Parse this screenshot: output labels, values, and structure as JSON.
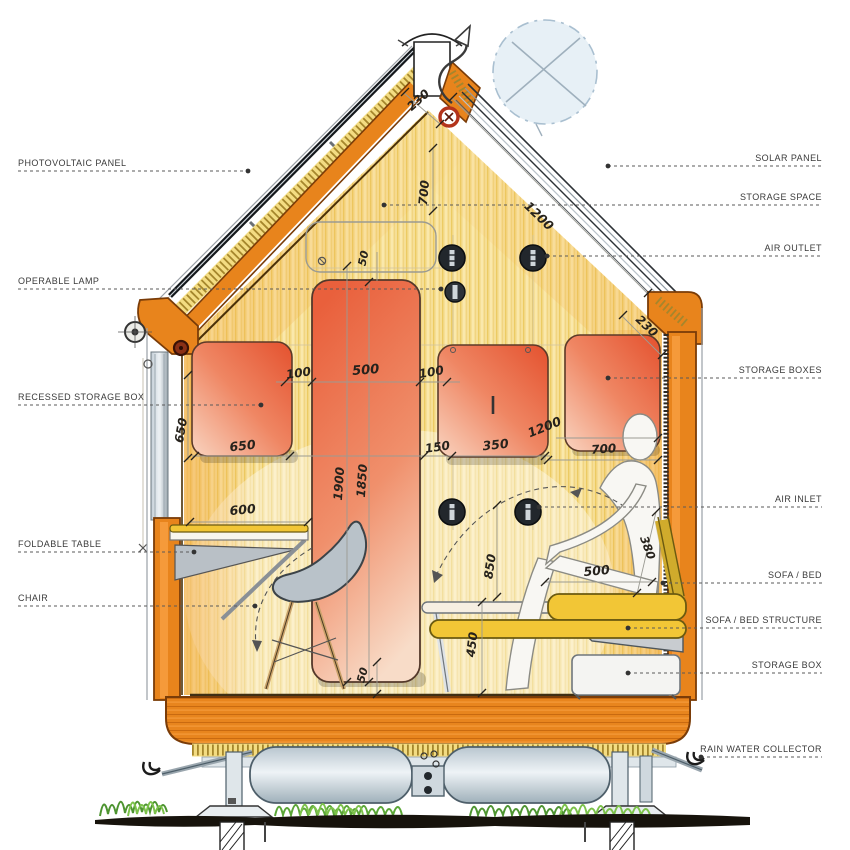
{
  "diagram": {
    "type": "architectural-section",
    "subject": "micro cabin / tiny house cross-section with callouts and millimetre dimensions"
  },
  "callouts": {
    "left": [
      {
        "label": "PHOTOVOLTAIC PANEL"
      },
      {
        "label": "OPERABLE LAMP"
      },
      {
        "label": "RECESSED STORAGE BOX"
      },
      {
        "label": "FOLDABLE TABLE"
      },
      {
        "label": "CHAIR"
      }
    ],
    "right": [
      {
        "label": "SOLAR PANEL"
      },
      {
        "label": "STORAGE SPACE"
      },
      {
        "label": "AIR OUTLET"
      },
      {
        "label": "STORAGE BOXES"
      },
      {
        "label": "AIR INLET"
      },
      {
        "label": "SOFA / BED"
      },
      {
        "label": "SOFA / BED STRUCTURE"
      },
      {
        "label": "STORAGE BOX"
      },
      {
        "label": "RAIN WATER COLLECTOR"
      }
    ]
  },
  "dimensions": [
    {
      "v": "230"
    },
    {
      "v": "50"
    },
    {
      "v": "700"
    },
    {
      "v": "1200"
    },
    {
      "v": "230"
    },
    {
      "v": "100"
    },
    {
      "v": "500"
    },
    {
      "v": "100"
    },
    {
      "v": "650"
    },
    {
      "v": "650"
    },
    {
      "v": "1900"
    },
    {
      "v": "1850"
    },
    {
      "v": "150"
    },
    {
      "v": "350"
    },
    {
      "v": "1200"
    },
    {
      "v": "700"
    },
    {
      "v": "600"
    },
    {
      "v": "850"
    },
    {
      "v": "500"
    },
    {
      "v": "380"
    },
    {
      "v": "450"
    },
    {
      "v": "50"
    }
  ],
  "colors": {
    "structure_orange": "#e8841c",
    "panel_red": "#e8603e",
    "sofa_yellow": "#f2c636",
    "insulation_yellow": "#f3dc82",
    "interior_wood": "#f6df96",
    "grass_green": "#5aa636",
    "sun_blue": "#e3edf5",
    "solar_panel_dark": "#14181c"
  }
}
